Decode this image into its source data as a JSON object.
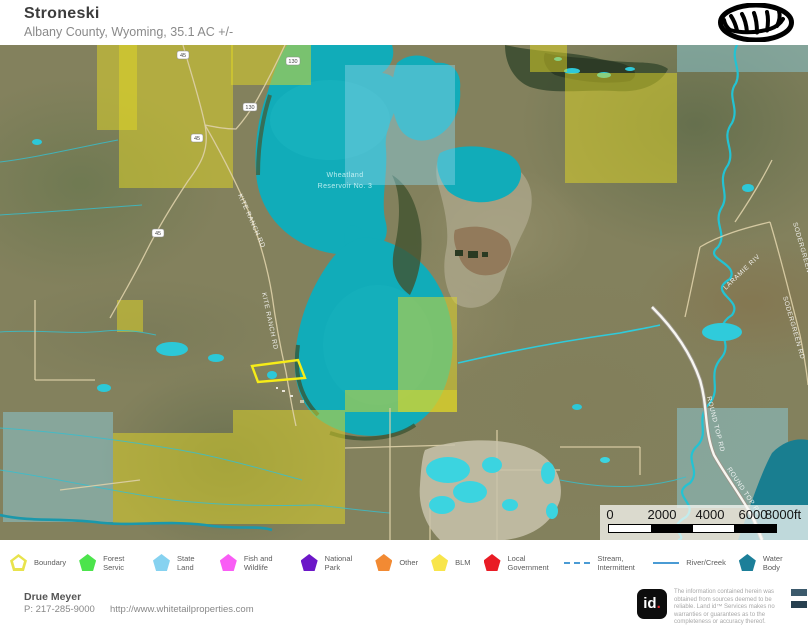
{
  "header": {
    "title": "Stroneski",
    "subtitle": "Albany County, Wyoming, 35.1 AC +/-"
  },
  "map": {
    "water_body_label": {
      "line1": "Wheatland",
      "line2": "Reservoir No. 3"
    },
    "road_labels": {
      "kite_ranch": "KITE RANCH RD",
      "laramie_river": "LARAMIE RIV",
      "sodergreen": "SODERGREEN RD",
      "round_top": "ROUND TOP RD"
    },
    "shields": {
      "hwy_top": "130",
      "hwy_mid": "130",
      "county_1": "45",
      "county_2": "45",
      "county_3": "45"
    },
    "scale_bar": {
      "ticks": [
        "0",
        "2000",
        "4000",
        "6000"
      ],
      "last_tick": "8000ft"
    }
  },
  "legend": {
    "items": [
      {
        "label": "Boundary",
        "type": "outline",
        "color": "#e8e34d"
      },
      {
        "label": "Forest Servic",
        "type": "fill",
        "color": "#4ce44c"
      },
      {
        "label": "State Land",
        "type": "fill",
        "color": "#86d2f0"
      },
      {
        "label": "Fish and Wildlife",
        "type": "fill",
        "color": "#f95df5"
      },
      {
        "label": "National Park",
        "type": "fill",
        "color": "#6c17c8"
      },
      {
        "label": "Other",
        "type": "fill",
        "color": "#f28a33"
      },
      {
        "label": "BLM",
        "type": "fill",
        "color": "#f8e54b"
      },
      {
        "label": "Local Government",
        "type": "fill",
        "color": "#e91c25"
      },
      {
        "label": "Stream, Intermittent",
        "type": "dashed-line",
        "color": "#4a9bd4"
      },
      {
        "label": "River/Creek",
        "type": "line",
        "color": "#4a9bd4"
      },
      {
        "label": "Water Body",
        "type": "fill",
        "color": "#1c7f99"
      }
    ]
  },
  "footer": {
    "agent": "Drue Meyer",
    "phone": "P: 217-285-9000",
    "website": "http://www.whitetailproperties.com",
    "logo_id": "id",
    "logo_dot": ".",
    "disclaimer_1": "The information contained herein was obtained from sources deemed to be reliable.",
    "disclaimer_2": " Land id™ Services makes no warranties or guarantees as to the completeness or accuracy thereof."
  }
}
